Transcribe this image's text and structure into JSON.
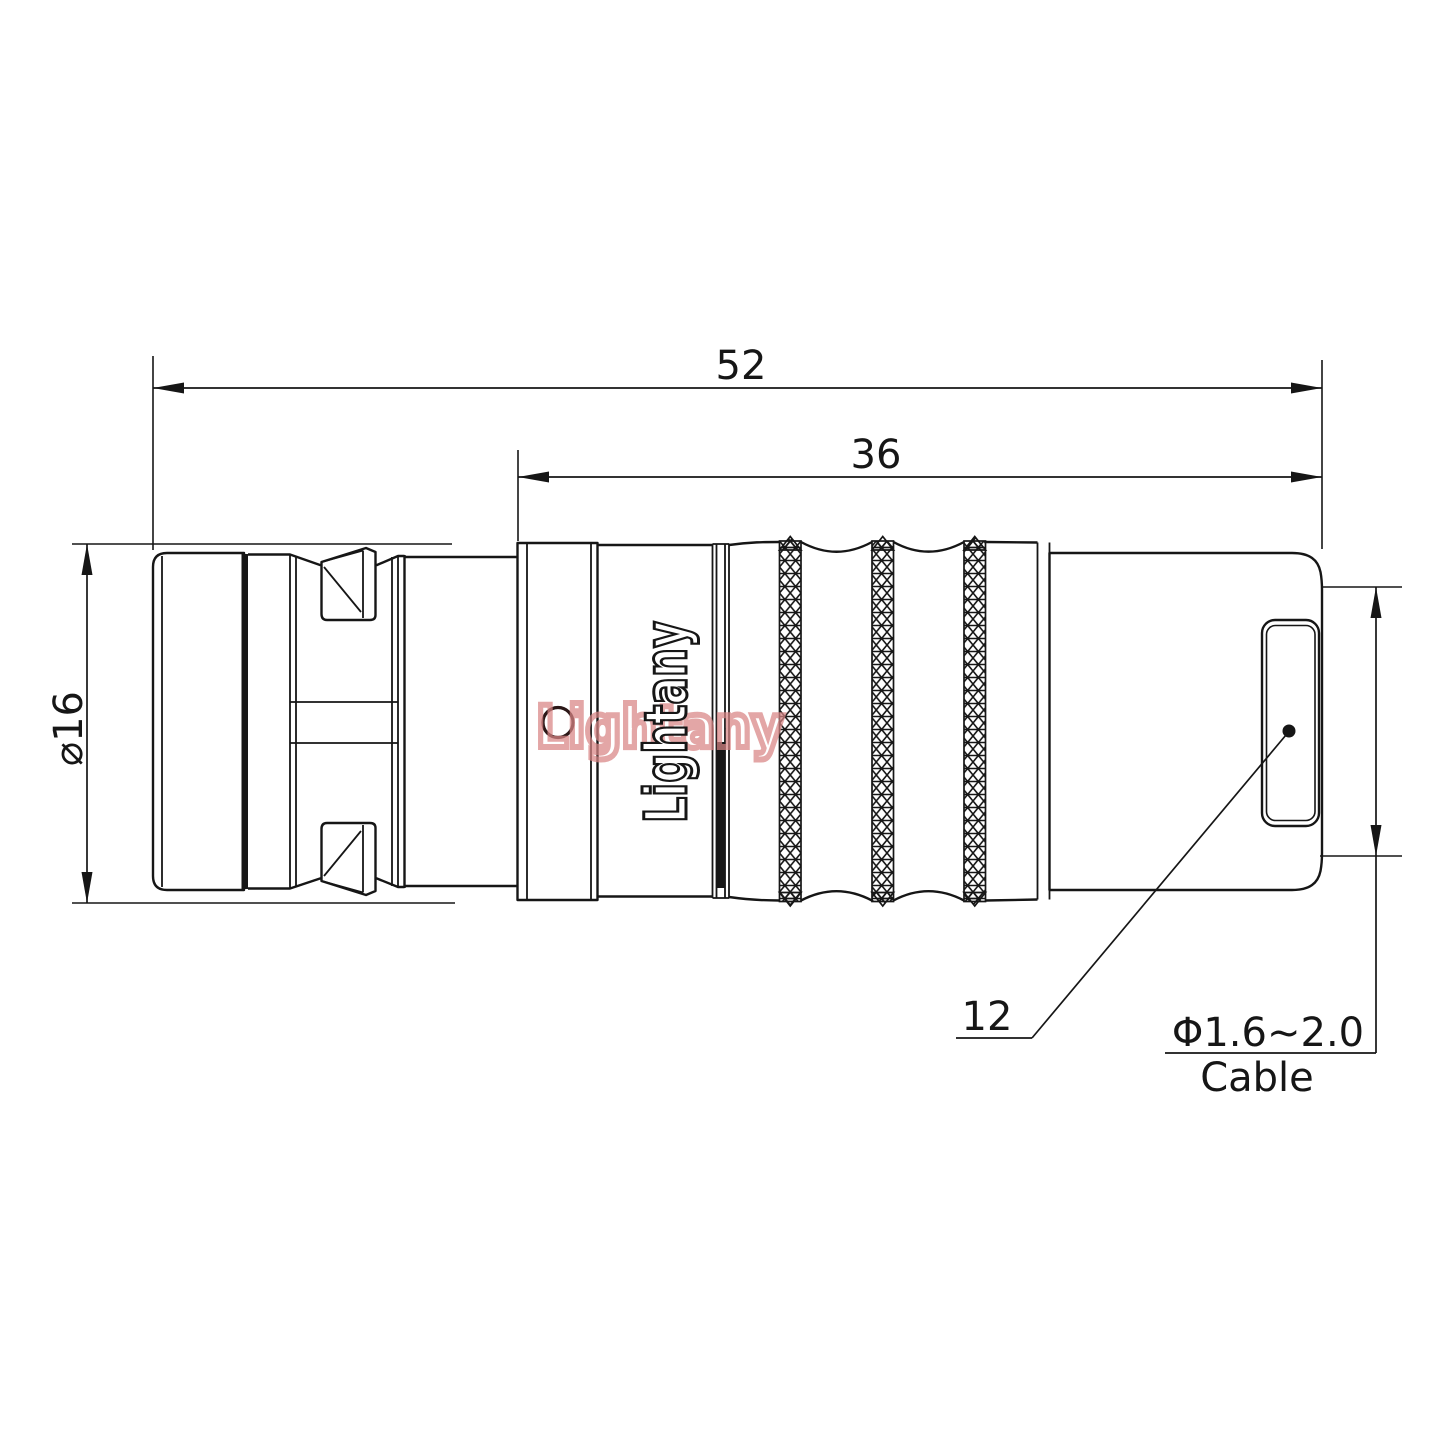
{
  "title": "Connector technical drawing",
  "dims": {
    "overall_length": "52",
    "front_length": "36",
    "outer_diameter": "⌀16",
    "rear_size": "12",
    "cable_range": "Φ1.6~2.0",
    "cable_word": "Cable"
  },
  "brand": {
    "logo_vertical": "Lightany",
    "watermark": "Lightany"
  },
  "colors": {
    "line": "#161616",
    "watermark_red": "#d98585",
    "hole_ring": "#2b1717",
    "background": "#ffffff"
  }
}
